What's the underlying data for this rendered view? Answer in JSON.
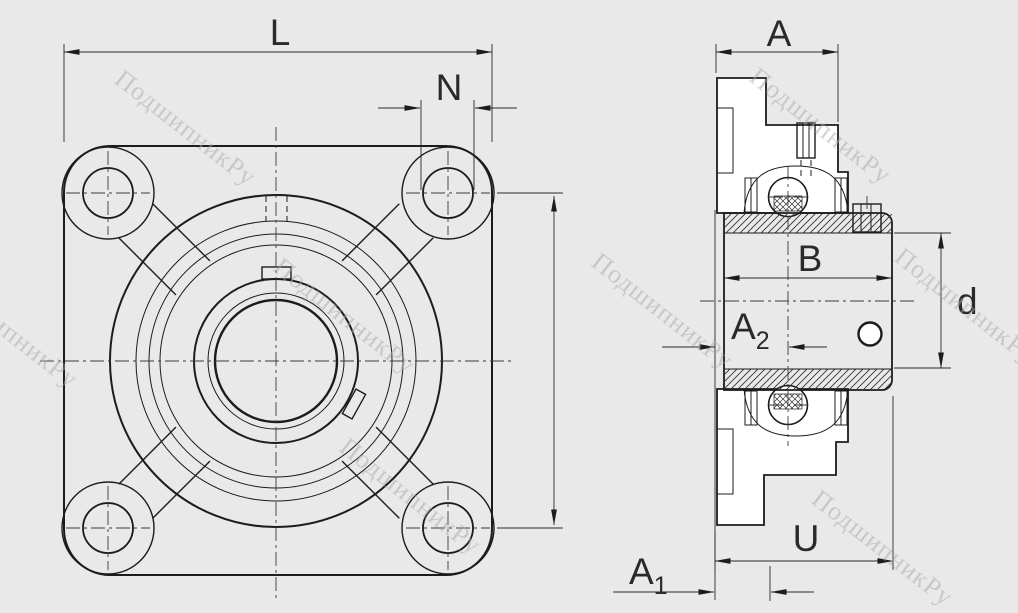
{
  "colors": {
    "background": "#e9e9e9",
    "paper": "#ffffff",
    "line": "#1c1c1c",
    "dimension_text": "#2a2a2a",
    "watermark": "#a9a9a9"
  },
  "watermark": {
    "text": "ПодшипникРу"
  },
  "dimensions": {
    "L": "L",
    "N": "N",
    "A": "A",
    "B": "B",
    "d": "d",
    "U": "U",
    "A1_base": "A",
    "A1_sub": "1",
    "A2_base": "A",
    "A2_sub": "2"
  }
}
